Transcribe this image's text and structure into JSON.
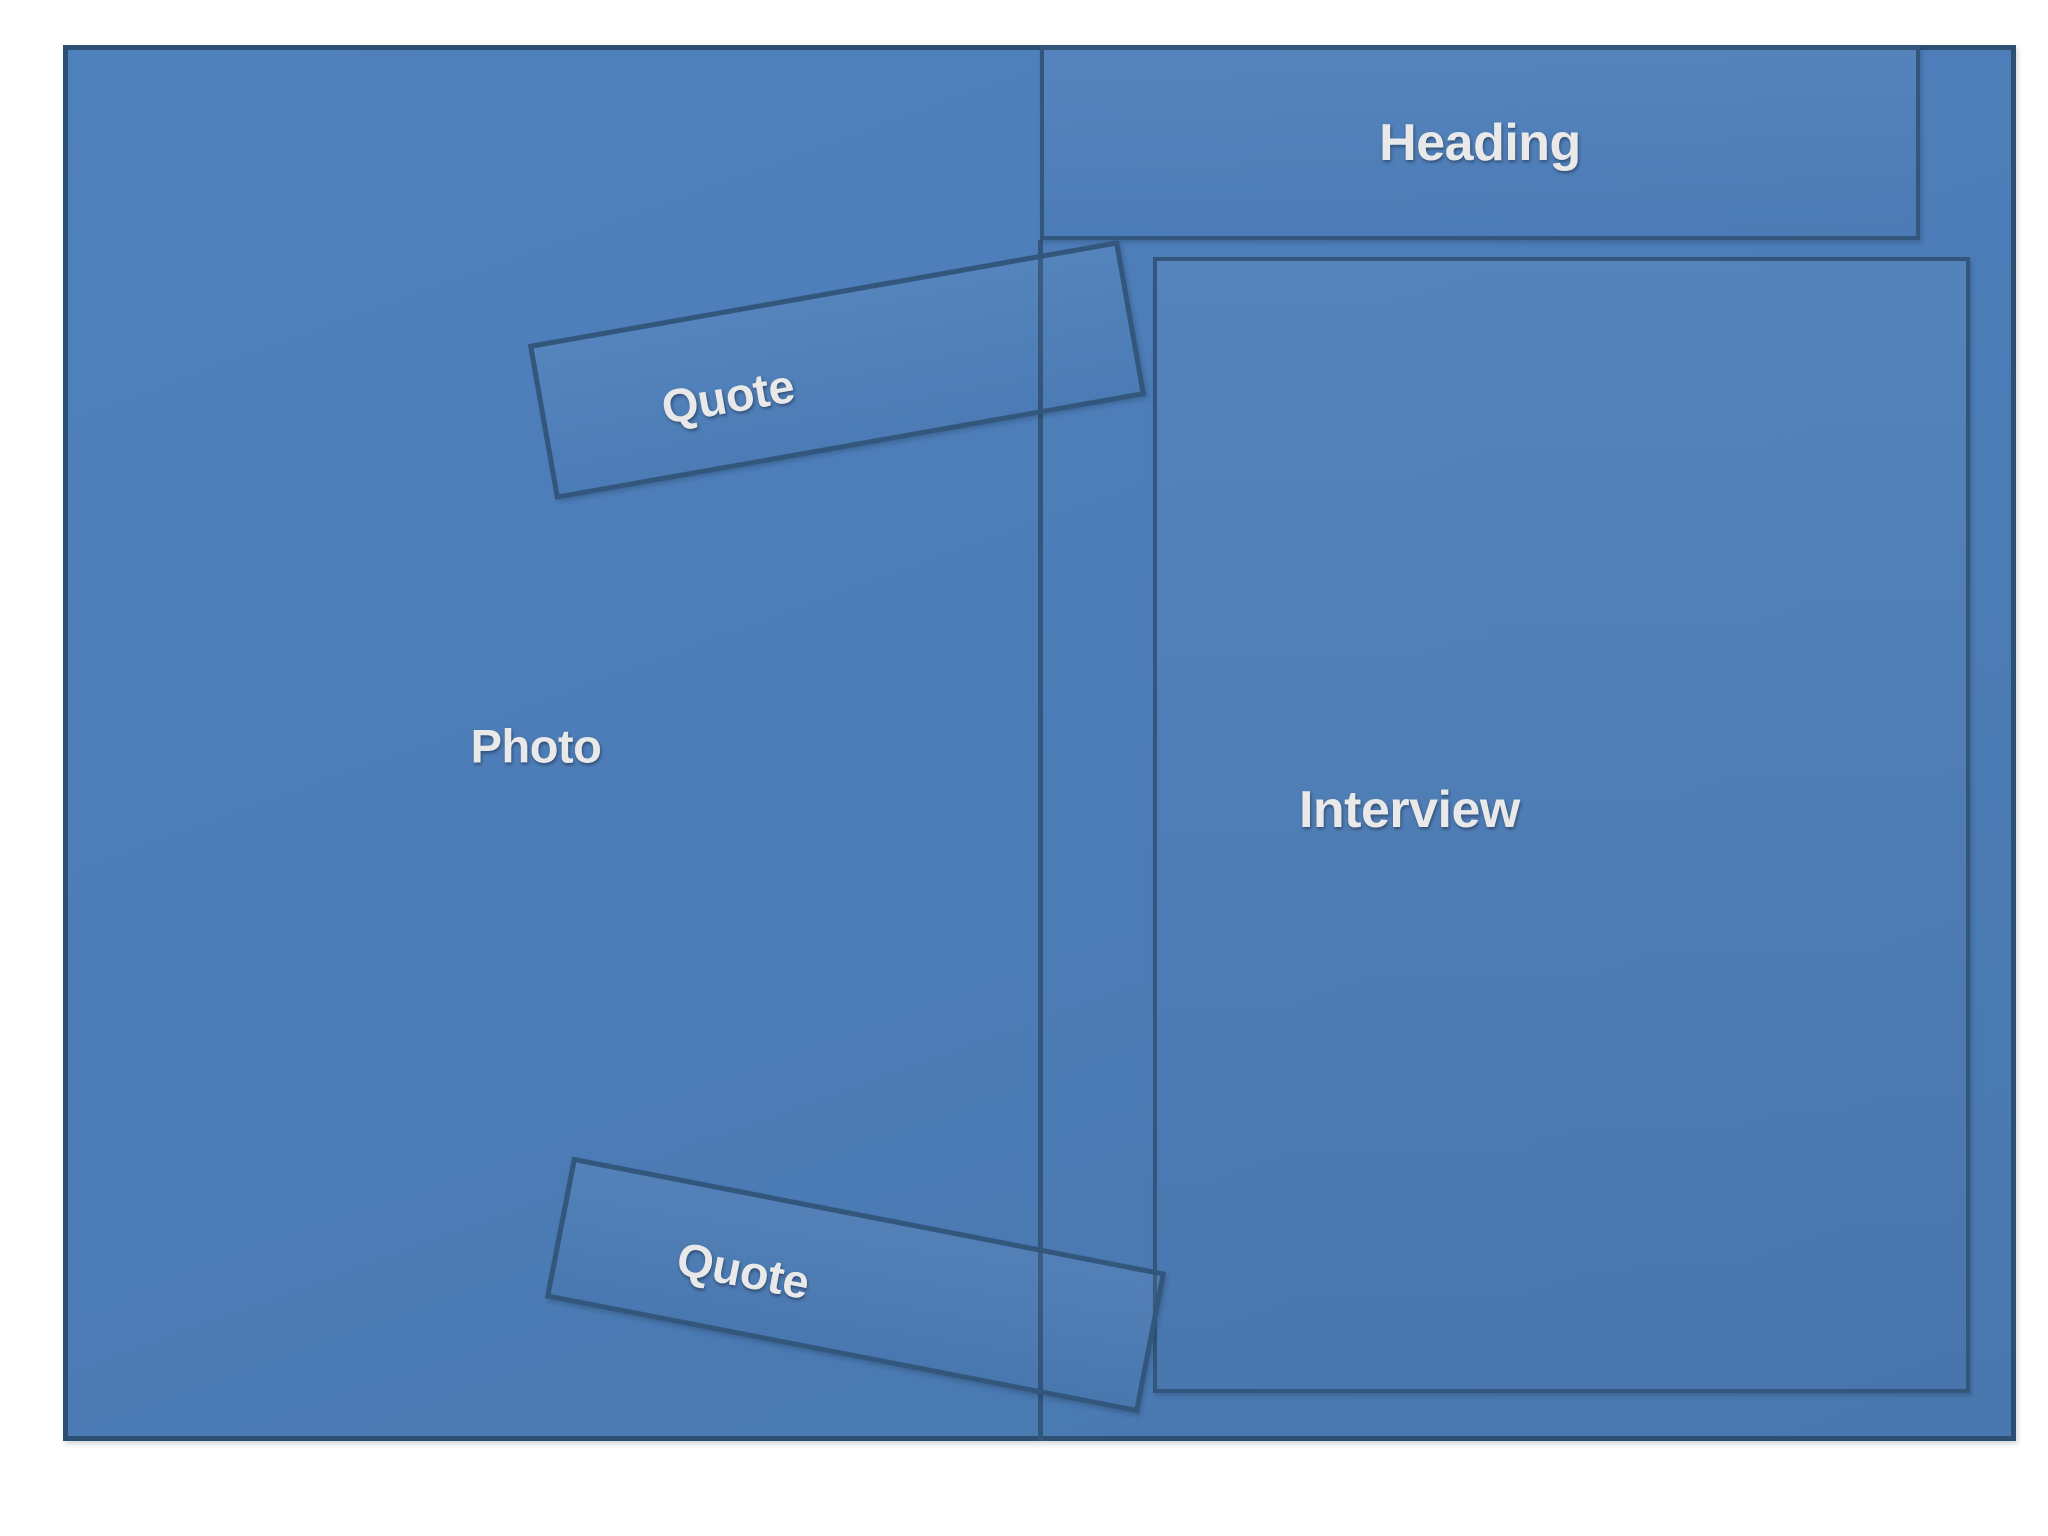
{
  "slide": {
    "background_color": "#ffffff",
    "canvas_fill": "#4d7db8",
    "canvas_border_color": "#2d4f71",
    "box_border_color": "#33567c",
    "label_color": "#e9e9e9",
    "regions": {
      "photo": {
        "label": "Photo"
      },
      "heading": {
        "label": "Heading"
      },
      "interview": {
        "label": "Interview"
      },
      "quote_top": {
        "label": "Quote"
      },
      "quote_bottom": {
        "label": "Quote"
      }
    }
  }
}
